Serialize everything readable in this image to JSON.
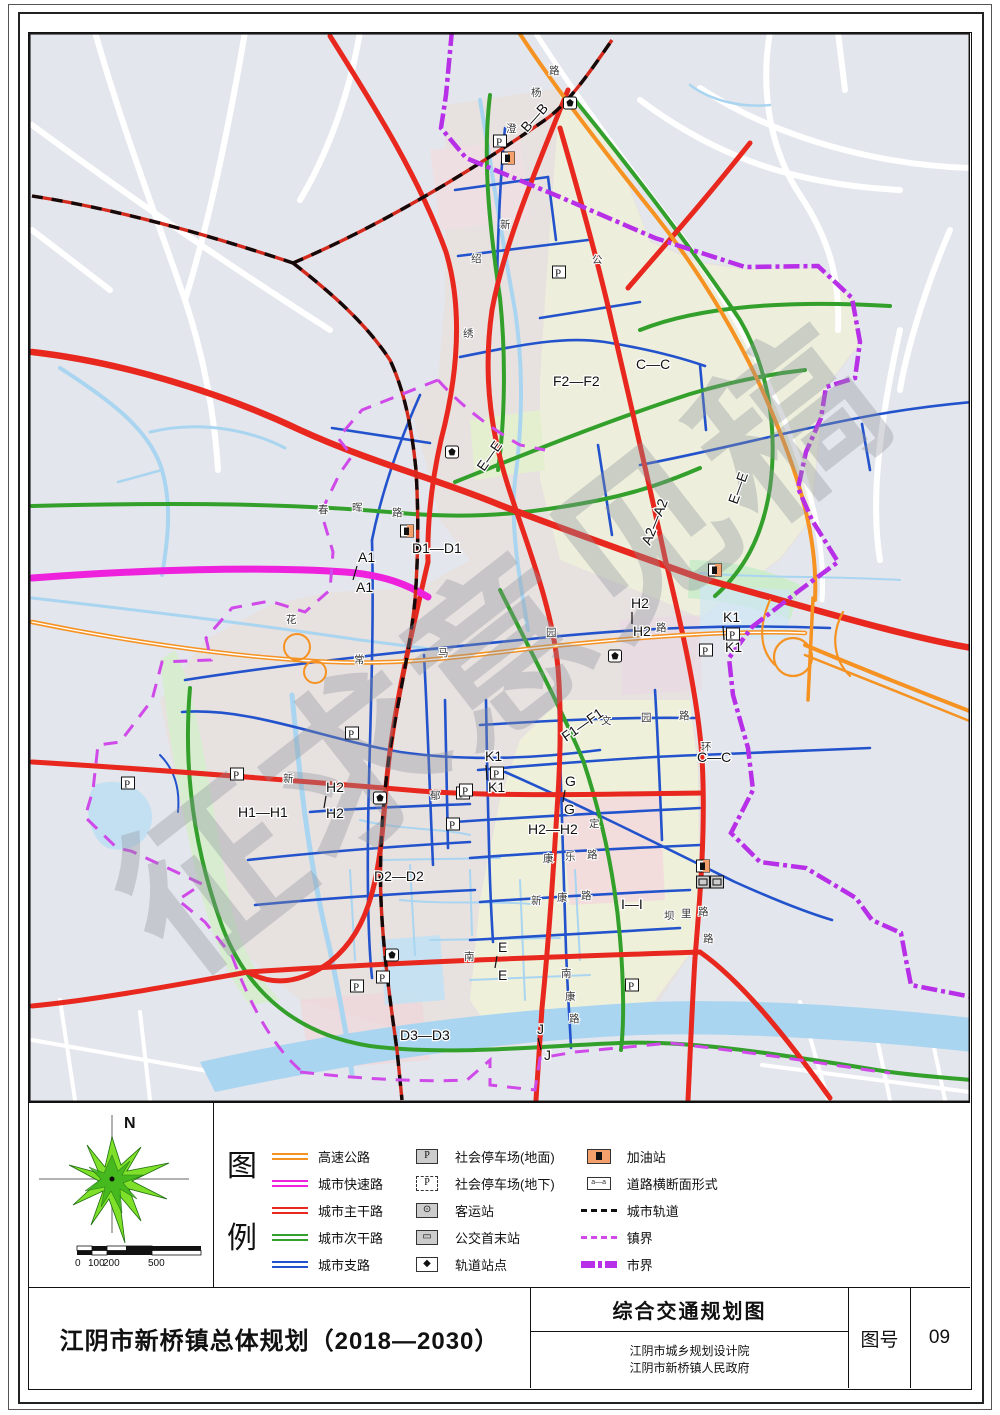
{
  "watermark": "征求意见稿",
  "colors": {
    "background": "#e3e6ec",
    "water": "#aad5f0",
    "expressway": "#f59222",
    "urban_expressway": "#ee22dd",
    "arterial": "#e8281e",
    "secondary": "#33a02c",
    "branch": "#2353cc",
    "rail_base": "#d42a1e",
    "rail_dash": "#140a0a",
    "city_boundary": "#b82fe8",
    "town_boundary": "#cf4ae8"
  },
  "legend": {
    "heading": [
      "图",
      "例"
    ],
    "col1": [
      {
        "label": "高速公路",
        "color": "#f59222"
      },
      {
        "label": "城市快速路",
        "color": "#ee22dd"
      },
      {
        "label": "城市主干路",
        "color": "#e8281e"
      },
      {
        "label": "城市次干路",
        "color": "#33a02c"
      },
      {
        "label": "城市支路",
        "color": "#2353cc"
      }
    ],
    "col2": [
      {
        "label": "社会停车场(地面)",
        "icon": "parking-ground"
      },
      {
        "label": "社会停车场(地下)",
        "icon": "parking-underground"
      },
      {
        "label": "客运站",
        "icon": "passenger-station"
      },
      {
        "label": "公交首末站",
        "icon": "bus-terminal"
      },
      {
        "label": "轨道站点",
        "icon": "rail-station"
      }
    ],
    "col3": [
      {
        "label": "加油站",
        "icon": "gas-station"
      },
      {
        "label": "道路横断面形式",
        "icon": "cross-section"
      },
      {
        "label": "城市轨道",
        "icon": "rail-line"
      },
      {
        "label": "镇界",
        "icon": "town-boundary"
      },
      {
        "label": "市界",
        "icon": "city-boundary"
      }
    ]
  },
  "compass": {
    "north_label": "N"
  },
  "scalebar": {
    "labels": [
      "0",
      "100",
      "200",
      "500",
      "1000m"
    ]
  },
  "titlebar": {
    "project_title": "江阴市新桥镇总体规划（2018—2030）",
    "drawing_title": "综合交通规划图",
    "org1": "江阴市城乡规划设计院",
    "org2": "江阴市新桥镇人民政府",
    "fig_label": "图号",
    "fig_no": "09"
  },
  "map": {
    "section_labels": [
      {
        "t": "B—B",
        "x": 527,
        "y": 133,
        "r": -48
      },
      {
        "t": "A1",
        "x": 358,
        "y": 562,
        "r": 0
      },
      {
        "t": "A1",
        "x": 356,
        "y": 592,
        "r": 0
      },
      {
        "t": "D1—D1",
        "x": 412,
        "y": 553,
        "r": 0
      },
      {
        "t": "A2—A2",
        "x": 650,
        "y": 546,
        "r": -68
      },
      {
        "t": "F2—F2",
        "x": 553,
        "y": 386,
        "r": 0
      },
      {
        "t": "C—C",
        "x": 636,
        "y": 369,
        "r": 0
      },
      {
        "t": "C—C",
        "x": 697,
        "y": 762,
        "r": 0
      },
      {
        "t": "E—E",
        "x": 484,
        "y": 472,
        "r": -55
      },
      {
        "t": "E—E",
        "x": 737,
        "y": 505,
        "r": -70
      },
      {
        "t": "E",
        "x": 498,
        "y": 952,
        "r": 0
      },
      {
        "t": "E",
        "x": 498,
        "y": 980,
        "r": 0
      },
      {
        "t": "F1—F1",
        "x": 566,
        "y": 742,
        "r": -35
      },
      {
        "t": "G",
        "x": 565,
        "y": 786,
        "r": 0
      },
      {
        "t": "G",
        "x": 564,
        "y": 814,
        "r": 0
      },
      {
        "t": "H1—H1",
        "x": 238,
        "y": 817,
        "r": 0
      },
      {
        "t": "H2",
        "x": 631,
        "y": 608,
        "r": 0
      },
      {
        "t": "H2",
        "x": 633,
        "y": 636,
        "r": 0
      },
      {
        "t": "H2",
        "x": 326,
        "y": 792,
        "r": 0
      },
      {
        "t": "H2",
        "x": 326,
        "y": 818,
        "r": 0
      },
      {
        "t": "H2—H2",
        "x": 528,
        "y": 834,
        "r": 0
      },
      {
        "t": "D2—D2",
        "x": 374,
        "y": 881,
        "r": 0
      },
      {
        "t": "D3—D3",
        "x": 400,
        "y": 1040,
        "r": 0
      },
      {
        "t": "I—I",
        "x": 621,
        "y": 909,
        "r": 0
      },
      {
        "t": "J",
        "x": 537,
        "y": 1034,
        "r": 0
      },
      {
        "t": "J",
        "x": 544,
        "y": 1060,
        "r": 0
      },
      {
        "t": "K1",
        "x": 485,
        "y": 761,
        "r": 0
      },
      {
        "t": "K1",
        "x": 488,
        "y": 792,
        "r": 0
      },
      {
        "t": "K1",
        "x": 723,
        "y": 622,
        "r": 0
      },
      {
        "t": "K1",
        "x": 725,
        "y": 652,
        "r": 0
      }
    ],
    "ticks": [
      {
        "x1": 357,
        "y1": 566,
        "x2": 353,
        "y2": 580
      },
      {
        "x1": 497,
        "y1": 956,
        "x2": 495,
        "y2": 968
      },
      {
        "x1": 565,
        "y1": 790,
        "x2": 563,
        "y2": 802
      },
      {
        "x1": 632,
        "y1": 612,
        "x2": 632,
        "y2": 624
      },
      {
        "x1": 326,
        "y1": 796,
        "x2": 324,
        "y2": 808
      },
      {
        "x1": 538,
        "y1": 1038,
        "x2": 541,
        "y2": 1050
      },
      {
        "x1": 486,
        "y1": 765,
        "x2": 487,
        "y2": 780
      },
      {
        "x1": 723,
        "y1": 626,
        "x2": 724,
        "y2": 640
      }
    ],
    "road_chars": [
      {
        "t": "路",
        "x": 549,
        "y": 74
      },
      {
        "t": "杨",
        "x": 531,
        "y": 96
      },
      {
        "t": "澄",
        "x": 506,
        "y": 132
      },
      {
        "t": "新",
        "x": 500,
        "y": 228
      },
      {
        "t": "绍",
        "x": 471,
        "y": 262
      },
      {
        "t": "绣",
        "x": 463,
        "y": 337
      },
      {
        "t": "公",
        "x": 592,
        "y": 263
      },
      {
        "t": "春",
        "x": 318,
        "y": 513
      },
      {
        "t": "晖",
        "x": 352,
        "y": 511
      },
      {
        "t": "路",
        "x": 392,
        "y": 516
      },
      {
        "t": "花",
        "x": 286,
        "y": 623
      },
      {
        "t": "常",
        "x": 354,
        "y": 663
      },
      {
        "t": "马",
        "x": 438,
        "y": 656
      },
      {
        "t": "园",
        "x": 546,
        "y": 636
      },
      {
        "t": "路",
        "x": 656,
        "y": 631
      },
      {
        "t": "环",
        "x": 701,
        "y": 750
      },
      {
        "t": "路",
        "x": 703,
        "y": 942
      },
      {
        "t": "郁",
        "x": 430,
        "y": 799
      },
      {
        "t": "新",
        "x": 283,
        "y": 782
      },
      {
        "t": "文",
        "x": 601,
        "y": 724
      },
      {
        "t": "园",
        "x": 641,
        "y": 721
      },
      {
        "t": "路",
        "x": 679,
        "y": 719
      },
      {
        "t": "康",
        "x": 543,
        "y": 862
      },
      {
        "t": "乐",
        "x": 565,
        "y": 860
      },
      {
        "t": "路",
        "x": 587,
        "y": 858
      },
      {
        "t": "新",
        "x": 531,
        "y": 904
      },
      {
        "t": "康",
        "x": 557,
        "y": 901
      },
      {
        "t": "路",
        "x": 581,
        "y": 899
      },
      {
        "t": "坝",
        "x": 664,
        "y": 919
      },
      {
        "t": "里",
        "x": 681,
        "y": 917
      },
      {
        "t": "路",
        "x": 698,
        "y": 915
      },
      {
        "t": "南",
        "x": 561,
        "y": 977
      },
      {
        "t": "康",
        "x": 565,
        "y": 1000
      },
      {
        "t": "路",
        "x": 569,
        "y": 1022
      },
      {
        "t": "南",
        "x": 464,
        "y": 960
      },
      {
        "t": "定",
        "x": 589,
        "y": 827
      }
    ],
    "parkings": [
      [
        500,
        141
      ],
      [
        559,
        272
      ],
      [
        352,
        733
      ],
      [
        237,
        774
      ],
      [
        128,
        783
      ],
      [
        463,
        793
      ],
      [
        497,
        773
      ],
      [
        466,
        790
      ],
      [
        733,
        634
      ],
      [
        706,
        650
      ],
      [
        453,
        824
      ],
      [
        357,
        986
      ],
      [
        383,
        977
      ],
      [
        632,
        985
      ]
    ],
    "stations": [
      [
        570,
        103
      ],
      [
        452,
        452
      ],
      [
        615,
        656
      ],
      [
        380,
        798
      ],
      [
        392,
        955
      ]
    ],
    "gas_stations": [
      [
        508,
        158
      ],
      [
        407,
        531
      ],
      [
        715,
        570
      ],
      [
        703,
        866
      ]
    ],
    "terminals": [
      [
        703,
        882
      ],
      [
        717,
        882
      ]
    ]
  }
}
